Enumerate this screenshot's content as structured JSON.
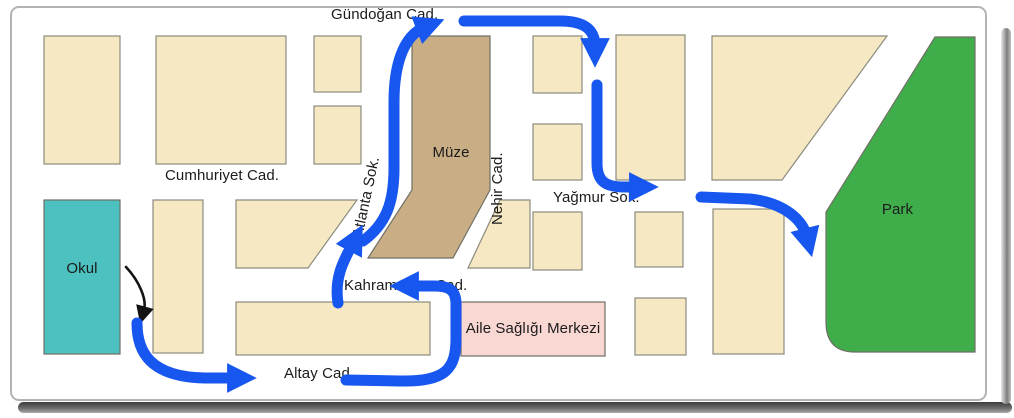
{
  "map": {
    "street_labels": {
      "gundogan": "Gündoğan Cad.",
      "cumhuriyet": "Cumhuriyet Cad.",
      "atlanta": "Atlanta Sok.",
      "nehir": "Nehir Cad.",
      "yagmur": "Yağmur Sok.",
      "kahramanlar": "Kahramanlar Cad.",
      "altay": "Altay Cad."
    },
    "place_labels": {
      "okul": "Okul",
      "muze": "Müze",
      "aile_sagligi": "Aile Sağlığı Merkezi",
      "park": "Park"
    },
    "colors": {
      "block": "#f5e8c2",
      "museum": "#c9ae85",
      "school": "#4cc1bf",
      "health_center": "#f9d7d2",
      "park": "#3fae4a",
      "route": "#1757ef",
      "start_arrow": "#141414"
    }
  }
}
